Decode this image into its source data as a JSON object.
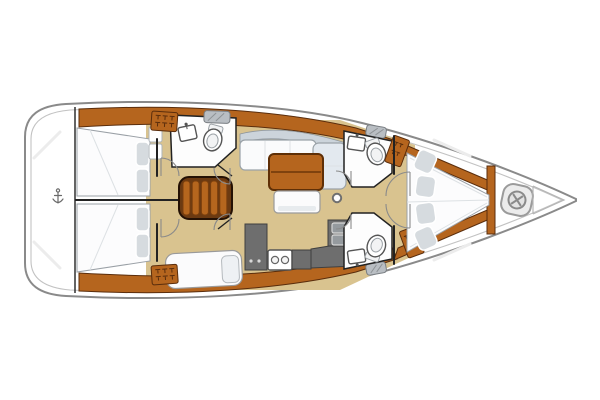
{
  "diagram": {
    "type": "boat-floorplan",
    "title": "Sailing yacht interior layout plan, top view, bow to the right"
  },
  "colors": {
    "hull_stroke": "#8a8a8a",
    "hull_inner": "#c2c2c2",
    "wood": "#b5651e",
    "wood_dark": "#5a2d0c",
    "floor": "#d9c38f",
    "counter": "#6e6e6e",
    "counter_dark": "#3f3f3f",
    "settee": "#e3e9ef",
    "pillow": "#d6dbdf",
    "wall": "#222222",
    "fixture_gray": "#b9bec3",
    "line_gray": "#8a8a8a",
    "steps": "#b5661e",
    "steps_base": "#6b3a12"
  },
  "labels": {
    "hull": "Hull and side decks",
    "swim_platform": "Transom swim platform",
    "ladder_icon": "swim-ladder-icon",
    "aft_cabin_top": "Aft double cabin (starboard)",
    "aft_cabin_bottom": "Aft double cabin (port)",
    "aft_head": "Aft head with toilet and sink",
    "companionway": "Companionway steps",
    "salon": "Salon settee with table and bench",
    "galley": "Galley with stove and double sink",
    "aft_bench": "Aft bench seat with cushion",
    "fwd_head_top": "Forward head (starboard) with toilet and sink",
    "fwd_head_bottom": "Forward head (port) with toilet and sink",
    "v_berth": "Forward owner cabin V-berth with four pillows",
    "windlass": "Bow locker with windlass",
    "wardrobe": "Wardrobe locker with hangers",
    "mast_post": "Mast compression post",
    "hatch": "Deck hatch"
  },
  "icons": [
    "swim-ladder-icon",
    "toilet-icon",
    "sink-icon",
    "stove-icon",
    "double-sink-icon",
    "hanger-icon",
    "windlass-icon",
    "hatch-icon",
    "door-swing-icon",
    "mast-post-icon"
  ]
}
